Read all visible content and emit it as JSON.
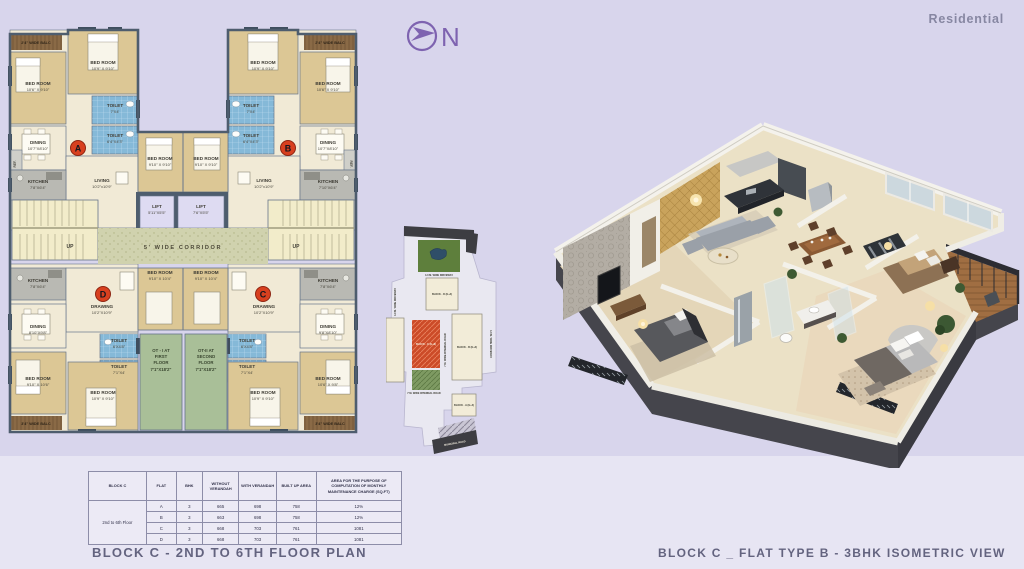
{
  "header": {
    "residential": "Residential",
    "north_letter": "N"
  },
  "titles": {
    "floor_plan": "BLOCK C - 2ND TO 6TH FLOOR PLAN",
    "isometric": "BLOCK C _ FLAT TYPE B - 3BHK ISOMETRIC VIEW"
  },
  "palette": {
    "background": "#d8d5ec",
    "bottom_band": "#e7e5f3",
    "accent_purple": "#7e63b0",
    "title_text": "#63637f",
    "marker_red": "#d8401f",
    "plan_wall": "#4e5d6e",
    "bedroom_tan": "#dcc795",
    "toilet_blue": "#85b9d8",
    "kitchen_gray": "#b9b9b3",
    "corridor_green": "#d0d2ae",
    "ot_green": "#a9bf98",
    "balcony_brown": "#8a6a46"
  },
  "fp": {
    "bedroom": "BED ROOM",
    "toilet": "TOILET",
    "dining": "DINING",
    "living": "LIVING",
    "kitchen": "KITCHEN",
    "drawing": "DRAWING",
    "lift": "LIFT",
    "up": "UP",
    "ref": "REF.",
    "corridor": "5' WIDE CORRIDOR",
    "balc_top": "2'4\" WIDE BALC",
    "balc_bottom": "3'4\" WIDE BALC",
    "markers": {
      "a": "A",
      "b": "B",
      "c": "C",
      "d": "D"
    },
    "dims": {
      "bed_a1": "10'6\" X 9'10\"",
      "bed_a2": "10'9\" X 9'10\"",
      "toilet_top": "7'X4'",
      "toilet_mid": "6'4\"X4'3\"",
      "dining_a": "10'7\"X8'10\"",
      "living_a": "10'2\"x10'9\"",
      "kitchen_a": "7'8\"X6'4\"",
      "kitchen_b": "7'10\"X6'4\"",
      "bed_center_top": "9'10\" X 9'10\"",
      "lift1": "5'11\"X5'5\"",
      "lift2": "7'6\"X5'5\"",
      "drawing_cd": "10'2\"X10'9\"",
      "bed_center_bot": "9'10\" X 10'4\"",
      "dining_d": "8'10\"X9'8\"",
      "dining_c": "9'8\"X8'10\"",
      "toilet_bot1": "6'X4'8\"",
      "toilet_bot2": "7'1\"X4'",
      "bed_bot": "10'9\" X 9'10\"",
      "bed_d_left": "9'10\" X 10'6\"",
      "bed_c_right": "10'6\" X 9'8\""
    },
    "ot1": [
      "OT - I AT",
      "FIRST",
      "FLOOR",
      "7'1\"X18'2\""
    ],
    "ot2": [
      "OT-II AT",
      "SECOND",
      "FLOOR",
      "7'1\"X18'2\""
    ]
  },
  "sp": {
    "driveway": "4.0 M. WIDE DRIVEWAY",
    "internal_road": "7 M. WIDE INTERNAL ROAD",
    "municipal_road": "MUNICIPAL ROAD",
    "block_a": "BLOCK - A (G+4)",
    "block_b": "BLOCK - B (G+4)",
    "block_c": "BLOCK - C (G+6)",
    "block_d": "BLOCK - D (G+4)"
  },
  "table": {
    "headers": [
      "BLOCK C",
      "FLAT",
      "BHK",
      "WITHOUT VERANDAH",
      "WITH VERANDAH",
      "BUILT UP AREA",
      "AREA FOR THE PURPOSE OF COMPUTATION OF MONTHLY MAINTENANCE CHARGE (SQ.FT)"
    ],
    "row_group": "2nd to 6th Floor",
    "rows": [
      [
        "A",
        "3",
        "665",
        "698",
        "758",
        "12%"
      ],
      [
        "B",
        "3",
        "663",
        "698",
        "758",
        "12%"
      ],
      [
        "C",
        "3",
        "668",
        "703",
        "761",
        "1081"
      ],
      [
        "D",
        "3",
        "668",
        "703",
        "761",
        "1081"
      ]
    ]
  }
}
